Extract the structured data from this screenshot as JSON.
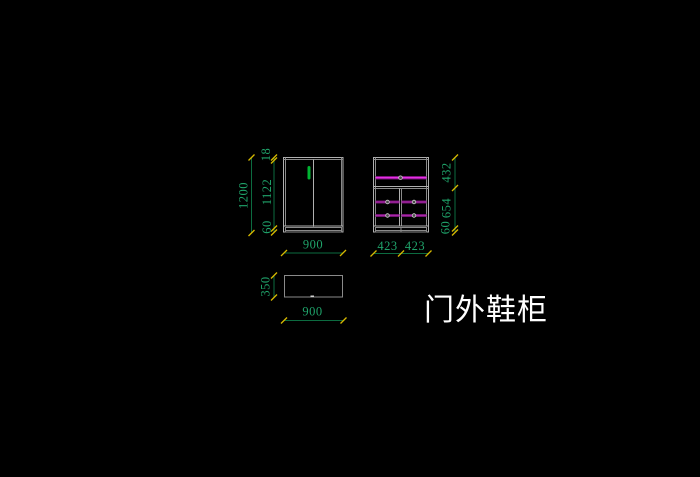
{
  "title": {
    "label": "门外鞋柜"
  },
  "front_view": {
    "overall_height": "1200",
    "top_thickness": "18",
    "door_height": "1122",
    "base_height": "60",
    "width": "900"
  },
  "internal_view": {
    "upper_section": "432",
    "lower_section": "654",
    "base_height": "60",
    "left_bay_width": "423",
    "right_bay_width": "423"
  },
  "plan_view": {
    "depth": "350",
    "width": "900"
  },
  "colors": {
    "background": "#000000",
    "outline": "#b0b0b0",
    "dimline": "#0c6b40",
    "dimtext": "#1fa36a",
    "tick": "#d6b800",
    "shelf_bright": "#e62ee6",
    "shelf_mid": "#a727a7",
    "shelf_dark": "#6e126e",
    "handle": "#00b432",
    "titletext": "#ffffff"
  }
}
